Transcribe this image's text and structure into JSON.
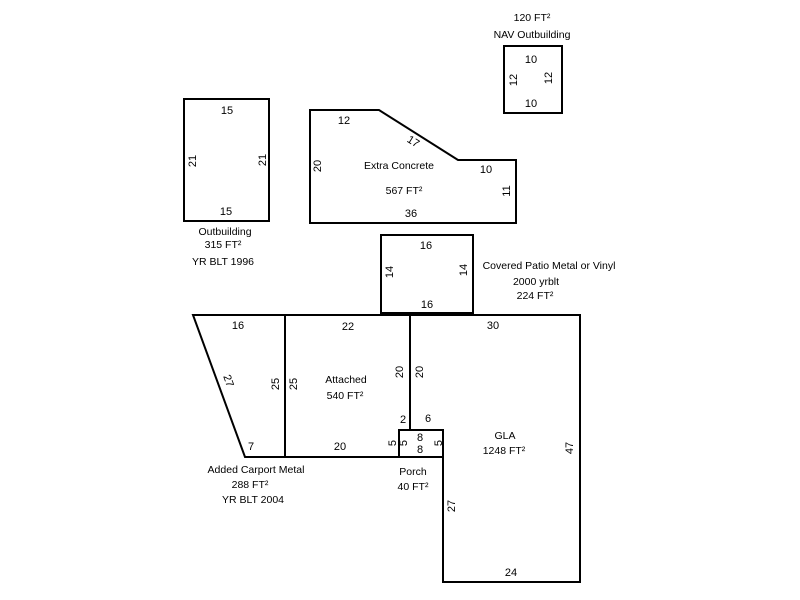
{
  "colors": {
    "background": "#ffffff",
    "line": "#000000",
    "text": "#000000"
  },
  "shapes": {
    "nav_outbuilding": {
      "area": "120 FT²",
      "name": "NAV Outbuilding",
      "dim_top": "10",
      "dim_left": "12",
      "dim_right": "12",
      "dim_bottom": "10"
    },
    "outbuilding": {
      "name": "Outbuilding",
      "area": "315 FT²",
      "year": "YR BLT 1996",
      "dim_top": "15",
      "dim_left": "21",
      "dim_right": "21",
      "dim_bottom": "15"
    },
    "extra_concrete": {
      "name": "Extra Concrete",
      "area": "567 FT²",
      "dim_top": "12",
      "dim_diagonal": "17",
      "dim_left": "20",
      "dim_step": "10",
      "dim_right": "11",
      "dim_bottom": "36"
    },
    "covered_patio": {
      "name": "Covered Patio Metal or Vinyl",
      "year": "2000 yrblt",
      "area": "224 FT²",
      "dim_top": "16",
      "dim_left": "14",
      "dim_right": "14",
      "dim_bottom": "16"
    },
    "carport": {
      "name": "Added Carport Metal",
      "area": "288 FT²",
      "year": "YR BLT 2004",
      "dim_top": "16",
      "dim_diagonal": "27",
      "dim_right": "25",
      "dim_bottom": "7"
    },
    "attached": {
      "name": "Attached",
      "area": "540 FT²",
      "dim_top": "22",
      "dim_left": "25",
      "dim_right": "20",
      "dim_bottom": "20",
      "dim_notch": "2"
    },
    "gla": {
      "name": "GLA",
      "area": "1248 FT²",
      "dim_top": "30",
      "dim_left": "20",
      "dim_notch": "6",
      "dim_right": "47",
      "dim_lower_left": "27",
      "dim_bottom": "24"
    },
    "porch": {
      "name": "Porch",
      "area": "40 FT²",
      "dim_top": "8",
      "dim_bottom": "8",
      "dim_left_outer": "5",
      "dim_left": "5",
      "dim_right": "5"
    }
  }
}
